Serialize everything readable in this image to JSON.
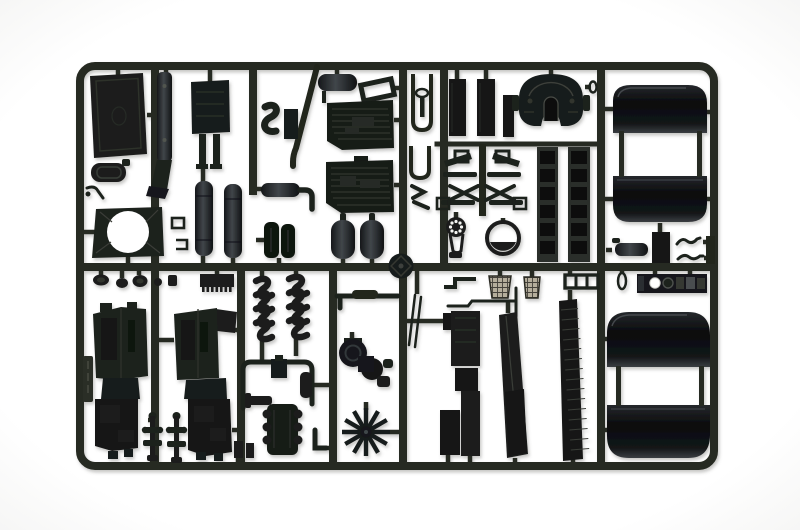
{
  "scene": {
    "type": "photograph",
    "subject": "Injection-molded sprue (parts tree) of black plastic scale-model truck components photographed on a white background",
    "sprue_shape": "rounded rectangle frame with internal vertical and horizontal runners",
    "visible_text": "",
    "parts": [
      "sprue-frame",
      "runner-grid",
      "radiator-panel",
      "exhaust-stack",
      "air-filter-box",
      "prong-bracket",
      "fan-shroud",
      "clamp-bits",
      "cab-floor-panel",
      "fuel-tank-left",
      "fuel-tank-right",
      "tire-pair",
      "horizontal-muffler",
      "s-hose",
      "diagonal-stay",
      "equipment-box",
      "roof-tank",
      "mirror-frame",
      "ribbed-panel-upper",
      "ribbed-panel-lower",
      "air-tank-left",
      "air-tank-right",
      "hub-disc",
      "u-bracket-upper",
      "t-stand",
      "u-bracket-lower",
      "angled-clips",
      "mud-flap-1",
      "mud-flap-2",
      "mud-flap-3",
      "fifth-wheel-coupler",
      "pin-oval-ring",
      "suspension-cluster",
      "belt-pulley",
      "gauge-ring",
      "ladder-frame-left",
      "ladder-frame-right",
      "fender-top-1",
      "fender-top-2",
      "fender-bottom-1",
      "fender-bottom-2",
      "fender-connectors",
      "step-cylinder",
      "junction-box",
      "wire-hook-1",
      "wire-hook-2",
      "edge-block",
      "small-parts-row",
      "comb-plate",
      "sprue-id-tag",
      "engine-block-left",
      "engine-block-right",
      "universal-joint-1",
      "universal-joint-2",
      "exhaust-manifold-1",
      "exhaust-manifold-2",
      "handlebar-pipe",
      "intake-manifold",
      "elbow-pipe",
      "small-cylinder",
      "small-blocks",
      "turbocharger",
      "cooling-fan",
      "pipe-bar",
      "antenna-rods",
      "step-bracket",
      "seat-cushion-1",
      "seat-cushion-2",
      "bent-rod",
      "panel-stack",
      "long-strip-middle",
      "long-strip-hatched",
      "h-frame",
      "dashboard-panel",
      "teardrop-ring"
    ]
  },
  "colors": {
    "background": "#ffffff",
    "sprue": "#272a20",
    "sprue_light": "#424639",
    "part_dark": "#1d201e",
    "part_darker": "#121414",
    "part_mid": "#343833",
    "part_light": "#4d514e",
    "gloss_highlight": "#3a3e43",
    "seat_fabric": "#b5ae9c",
    "seat_line": "#45423a",
    "hole_white": "#ffffff"
  }
}
